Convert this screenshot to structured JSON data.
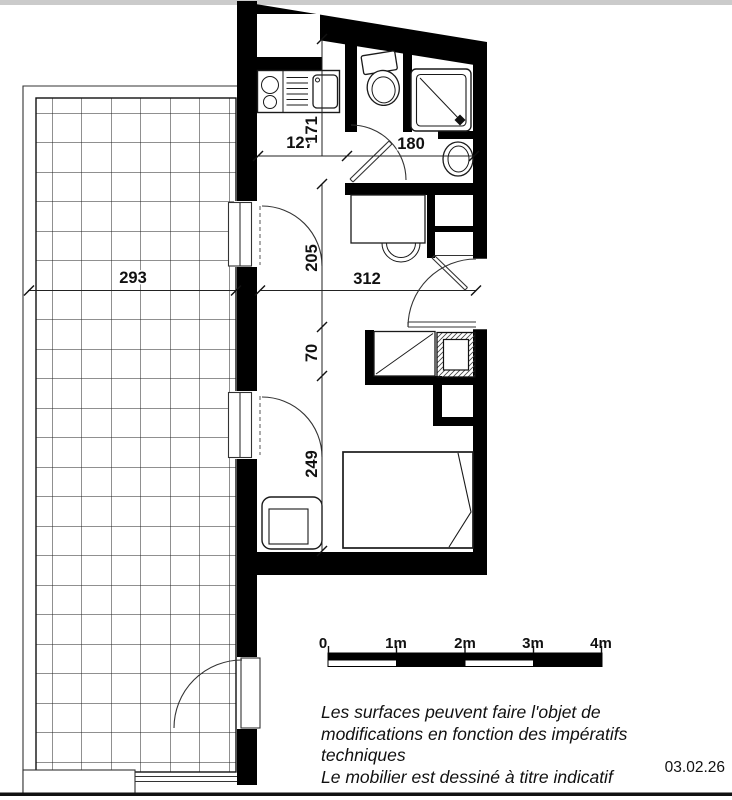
{
  "plan": {
    "dimensions": {
      "terrace_width": "293",
      "kitchen_width": "127",
      "kitchen_depth": "171",
      "bathroom_width": "180",
      "room_upper_depth": "205",
      "room_width": "312",
      "room_mid_depth": "70",
      "room_lower_depth": "249"
    },
    "scale_bar": {
      "labels": [
        "0",
        "1m",
        "2m",
        "3m",
        "4m"
      ]
    },
    "notes": {
      "line1": "Les surfaces peuvent faire l'objet de",
      "line2": "modifications en fonction des impératifs",
      "line3": "techniques",
      "line4": "Le mobilier est dessiné à titre indicatif"
    },
    "date": "03.02.26"
  }
}
